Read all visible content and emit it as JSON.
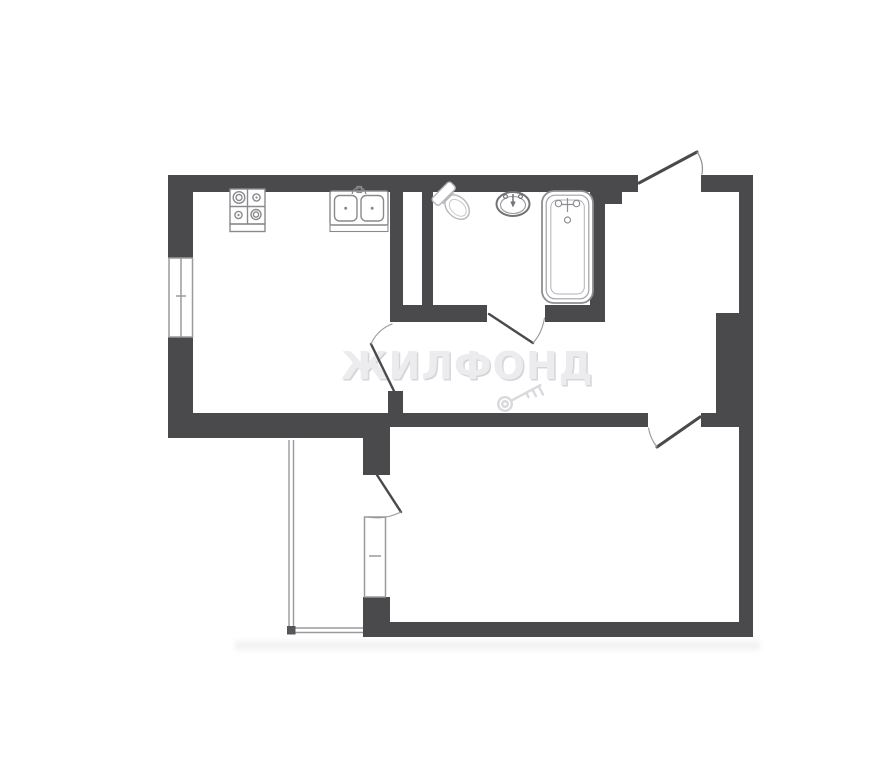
{
  "watermark": {
    "text": "ЖИЛФОНД",
    "icon": "key-icon",
    "color": "#ececef"
  },
  "palette": {
    "background": "#ffffff",
    "wall": "#4a4a4d",
    "fixture_line": "#8a8a8e",
    "light_fixture_line": "#b6b6ba",
    "railing_line": "#9a9a9e",
    "watermark_gray": "#dcdce0"
  },
  "plan": {
    "type": "apartment-floor-plan",
    "rooms": [
      {
        "name": "kitchen",
        "fixtures": [
          "stove-icon",
          "double-sink-icon"
        ],
        "openings": [
          "window-left-wall",
          "door-to-hall"
        ]
      },
      {
        "name": "bathroom",
        "fixtures": [
          "toilet-icon",
          "washbasin-icon",
          "bathtub-icon"
        ],
        "openings": [
          "door-to-hall"
        ]
      },
      {
        "name": "hall",
        "fixtures": [],
        "openings": [
          "entrance-door-top"
        ]
      },
      {
        "name": "living-room",
        "fixtures": [],
        "openings": [
          "door-from-hall",
          "balcony-door",
          "balcony-window"
        ]
      },
      {
        "name": "balcony",
        "fixtures": [
          "railing"
        ],
        "openings": []
      }
    ],
    "door_symbols": [
      "entrance-door",
      "bathroom-door",
      "kitchen-door",
      "living-room-door",
      "balcony-door"
    ],
    "window_symbols": [
      "kitchen-window",
      "living-room-balcony-window"
    ]
  }
}
